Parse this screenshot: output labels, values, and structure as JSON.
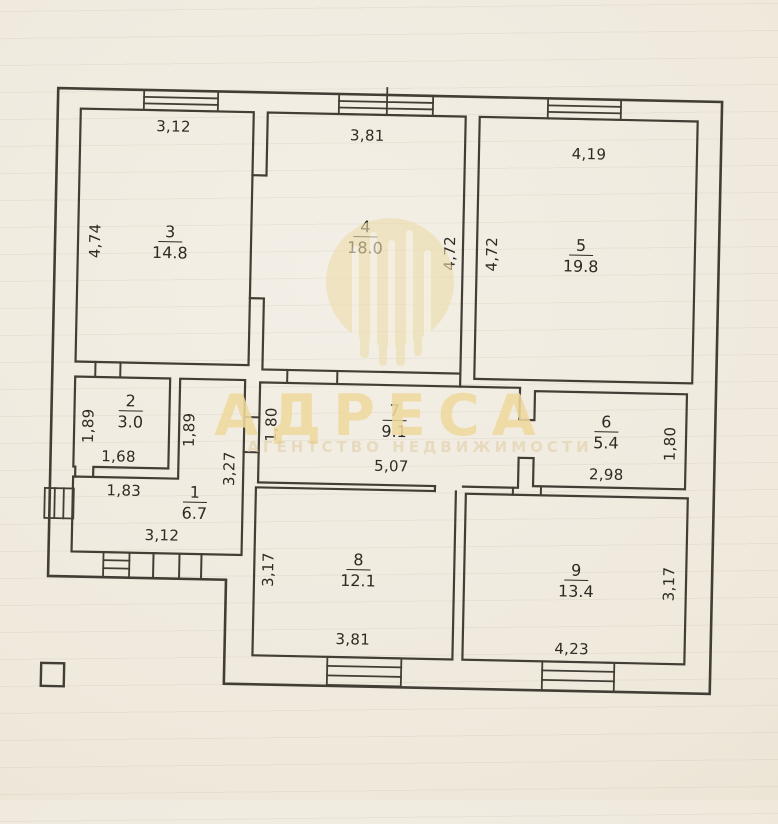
{
  "watermark": {
    "brand": "АДРЕСА",
    "tagline": "АГЕНТСТВО НЕДВИЖИМОСТИ"
  },
  "rooms": {
    "r1": {
      "number": "1",
      "area": "6.7"
    },
    "r2": {
      "number": "2",
      "area": "3.0"
    },
    "r3": {
      "number": "3",
      "area": "14.8"
    },
    "r4": {
      "number": "4",
      "area": "18.0"
    },
    "r5": {
      "number": "5",
      "area": "19.8"
    },
    "r6": {
      "number": "6",
      "area": "5.4"
    },
    "r7": {
      "number": "7",
      "area": "9.1"
    },
    "r8": {
      "number": "8",
      "area": "12.1"
    },
    "r9": {
      "number": "9",
      "area": "13.4"
    }
  },
  "dims": {
    "r3_width": "3,12",
    "r3_height": "4,74",
    "r4_width": "3,81",
    "r4_height": "4,72",
    "r5_height_left": "4,72",
    "r5_width": "4,19",
    "r2_height_left": "1,89",
    "r2_height_right": "1,89",
    "r2_width_inner": "1,68",
    "r2_width_outer": "1,83",
    "r1_height": "3,27",
    "r1_width": "3,12",
    "r7_height": "1,80",
    "r7_width": "5,07",
    "r6_width": "2,98",
    "r6_height": "1,80",
    "r8_height": "3,17",
    "r8_width": "3,81",
    "r9_width": "4,23",
    "r9_height": "3,17"
  }
}
